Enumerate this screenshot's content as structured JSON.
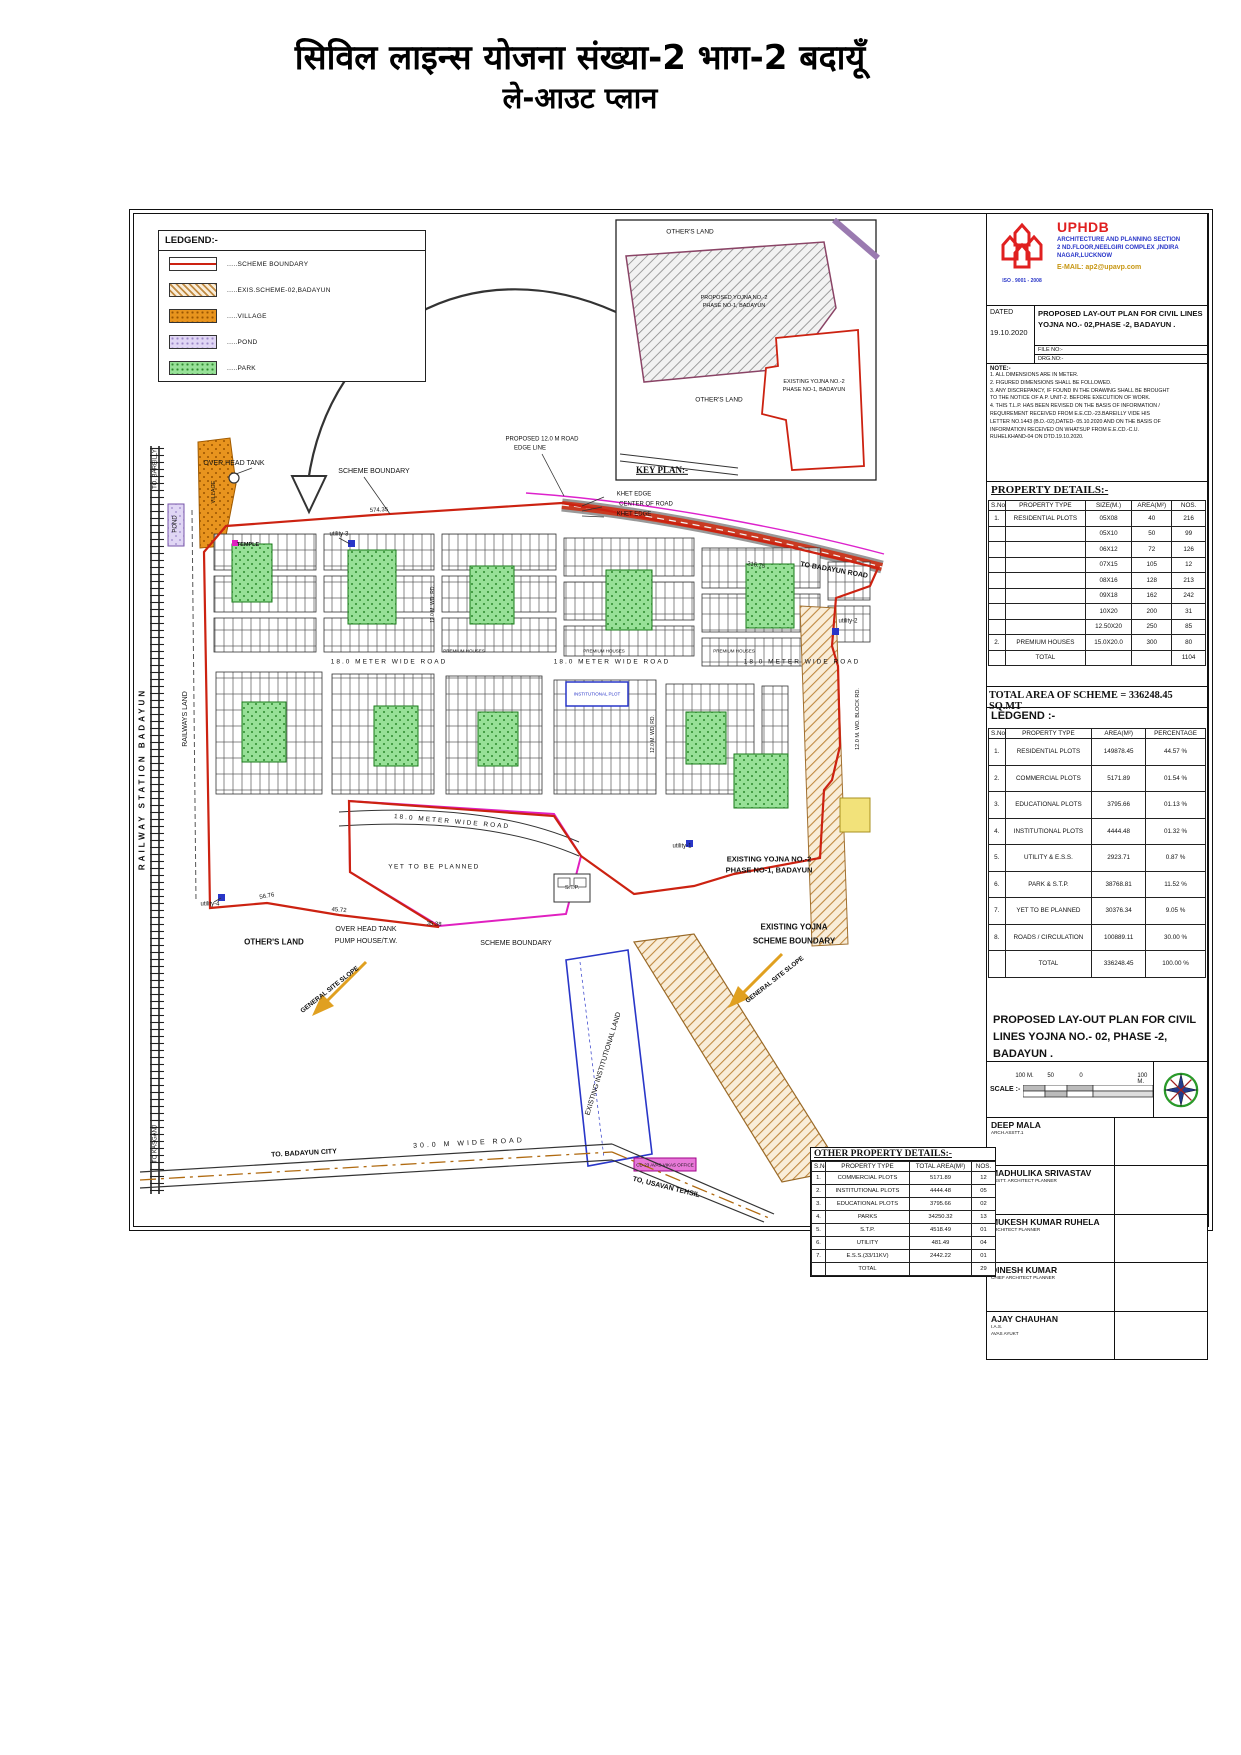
{
  "page_title": {
    "line1": "सिविल लाइन्स योजना संख्या-2 भाग-2 बदायूँ",
    "line2": "ले-आउट प्लान"
  },
  "legend_box": {
    "title": "LEDGEND:-",
    "items": [
      {
        "key": "scheme-boundary",
        "label": ".....SCHEME BOUNDARY"
      },
      {
        "key": "hatched",
        "label": ".....EXIS.SCHEME-02,BADAYUN"
      },
      {
        "key": "village",
        "label": ".....VILLAGE"
      },
      {
        "key": "pond",
        "label": ".....POND"
      },
      {
        "key": "park",
        "label": ".....PARK"
      }
    ]
  },
  "uphdb": {
    "org": "UPHDB",
    "iso": "ISO . 9001 - 2008",
    "dept": "ARCHITECTURE AND PLANNING SECTION",
    "address": "2 ND.FLOOR,NEELGIRI COMPLEX ,INDIRA NAGAR,LUCKNOW",
    "email_label": "E-MAIL:",
    "email": "ap2@upavp.com"
  },
  "title_block": {
    "dated_label": "DATED",
    "dated": "19.10.2020",
    "title": "PROPOSED LAY-OUT PLAN FOR CIVIL LINES YOJNA NO.- 02,PHASE -2, BADAYUN .",
    "file_no": "FILE NO:-",
    "drg_no": "DRG.NO:-"
  },
  "notes": {
    "heading": "NOTE:-",
    "lines": [
      "1. ALL DIMENSIONS ARE IN METER.",
      "2. FIGURED DIMENSIONS SHALL BE FOLLOWED.",
      "3. ANY DISCREPANCY, IF FOUND IN THE DRAWING SHALL BE BROUGHT",
      "    TO THE NOTICE OF A.P. UNIT-2. BEFORE EXECUTION OF WORK.",
      "4. THIS T.L.P. HAS BEEN REVISED ON THE BASIS OF INFORMATION /",
      "    REQUIREMENT RECEIVED FROM E.E.CD.-23.BAREILLY VIDE HIS",
      "    LETTER NO.1443 (B.D.-02),DATED- 05.10.2020 AND ON THE BASIS OF",
      "    INFORMATION RECEIVED ON WHATSUP FROM E.E.CD.-C.U.",
      "    RUHELKHAND-04 ON DTD.19.10.2020."
    ]
  },
  "property_details": {
    "title": "PROPERTY DETAILS:-",
    "columns": [
      "S.No.",
      "PROPERTY TYPE",
      "SIZE(M.)",
      "AREA(M²)",
      "NOS."
    ],
    "rows": [
      [
        "1.",
        "RESIDENTIAL PLOTS",
        "05X08",
        "40",
        "216"
      ],
      [
        "",
        "",
        "05X10",
        "50",
        "99"
      ],
      [
        "",
        "",
        "06X12",
        "72",
        "126"
      ],
      [
        "",
        "",
        "07X15",
        "105",
        "12"
      ],
      [
        "",
        "",
        "08X16",
        "128",
        "213"
      ],
      [
        "",
        "",
        "09X18",
        "162",
        "242"
      ],
      [
        "",
        "",
        "10X20",
        "200",
        "31"
      ],
      [
        "",
        "",
        "12.50X20",
        "250",
        "85"
      ],
      [
        "2.",
        "PREMIUM HOUSES",
        "15.0X20.0",
        "300",
        "80"
      ],
      [
        "",
        "TOTAL",
        "",
        "",
        "1104"
      ]
    ]
  },
  "total_area": "TOTAL AREA OF SCHEME = 336248.45 SQ.MT",
  "ledgend_table": {
    "title": "LEDGEND :-",
    "columns": [
      "S.No.",
      "PROPERTY TYPE",
      "AREA(M²)",
      "PERCENTAGE"
    ],
    "rows": [
      [
        "1.",
        "RESIDENTIAL PLOTS",
        "149878.45",
        "44.57 %"
      ],
      [
        "2.",
        "COMMERCIAL PLOTS",
        "5171.89",
        "01.54 %"
      ],
      [
        "3.",
        "EDUCATIONAL PLOTS",
        "3795.66",
        "01.13 %"
      ],
      [
        "4.",
        "INSTITUTIONAL PLOTS",
        "4444.48",
        "01.32 %"
      ],
      [
        "5.",
        "UTILITY & E.S.S.",
        "2923.71",
        "0.87 %"
      ],
      [
        "6.",
        "PARK & S.T.P.",
        "38768.81",
        "11.52 %"
      ],
      [
        "7.",
        "YET TO BE PLANNED",
        "30376.34",
        "9.05 %"
      ],
      [
        "8.",
        "ROADS / CIRCULATION",
        "100889.11",
        "30.00 %"
      ],
      [
        "",
        "TOTAL",
        "336248.45",
        "100.00 %"
      ]
    ]
  },
  "plan_title": "PROPOSED  LAY-OUT PLAN FOR CIVIL LINES YOJNA  NO.- 02, PHASE -2, BADAYUN .",
  "scale_bar": {
    "label": "SCALE :-",
    "ticks": [
      "100 M.",
      "50",
      "0",
      "100 M."
    ]
  },
  "signatures": [
    {
      "name": "DEEP MALA",
      "roles": [
        "ARCH.ASSTT.1"
      ]
    },
    {
      "name": "MADHULIKA SRIVASTAV",
      "roles": [
        "ASSTT. ARCHITECT PLANNER"
      ]
    },
    {
      "name": "MUKESH KUMAR RUHELA",
      "roles": [
        "ARCHITECT PLANNER"
      ]
    },
    {
      "name": "DINESH KUMAR",
      "roles": [
        "CHIEF ARCHITECT PLANNER"
      ]
    },
    {
      "name": "AJAY CHAUHAN",
      "roles": [
        "I.A.S.",
        "AVAS AYUKT"
      ]
    }
  ],
  "other_property": {
    "title": "OTHER PROPERTY DETAILS:-",
    "columns": [
      "S.No.",
      "PROPERTY TYPE",
      "TOTAL AREA(M²)",
      "NOS."
    ],
    "rows": [
      [
        "1.",
        "COMMERCIAL PLOTS",
        "5171.89",
        "12"
      ],
      [
        "2.",
        "INSTITUTIONAL PLOTS",
        "4444.48",
        "05"
      ],
      [
        "3.",
        "EDUCATIONAL PLOTS",
        "3795.66",
        "02"
      ],
      [
        "4.",
        "PARKS",
        "34250.32",
        "13"
      ],
      [
        "5.",
        "S.T.P.",
        "4518.49",
        "01"
      ],
      [
        "6.",
        "UTILITY",
        "481.49",
        "04"
      ],
      [
        "7.",
        "E.S.S.(33/11KV)",
        "2442.22",
        "01"
      ],
      [
        "",
        "TOTAL",
        "",
        "29"
      ]
    ]
  },
  "colors": {
    "scheme_boundary": "#cc2211",
    "exis_scheme_hatch": "#c08a42",
    "village": "#e8941e",
    "pond": "#e0d6f4",
    "park": "#97e097",
    "road_band": "#c93a22",
    "proposed_road_edge": "#dd22cc",
    "institutional": "#2936c8",
    "brand_red": "#e02020",
    "brand_blue": "#2936c8",
    "email_gold": "#c79612",
    "slope_arrow": "#e0a020"
  },
  "map_labels": [
    {
      "t": "OVER HEAD TANK",
      "x": 100,
      "y": 250,
      "s": 7
    },
    {
      "t": "SCHEME BOUNDARY",
      "x": 240,
      "y": 258,
      "s": 7
    },
    {
      "t": "PROPOSED 12.0 M ROAD",
      "x": 408,
      "y": 226,
      "s": 6
    },
    {
      "t": "EDGE LINE",
      "x": 396,
      "y": 235,
      "s": 6
    },
    {
      "t": "KHET EDGE",
      "x": 500,
      "y": 281,
      "s": 6
    },
    {
      "t": "CENTER OF ROAD",
      "x": 512,
      "y": 291,
      "s": 6
    },
    {
      "t": "KHET EDGE",
      "x": 500,
      "y": 301,
      "s": 6
    },
    {
      "t": "574.35",
      "x": 245,
      "y": 297,
      "s": 6,
      "r": -3
    },
    {
      "t": "216.75",
      "x": 622,
      "y": 352,
      "s": 6,
      "r": 9
    },
    {
      "t": "TO BADAYUN ROAD",
      "x": 700,
      "y": 357,
      "s": 7,
      "r": 10,
      "c": "b"
    },
    {
      "t": "utility-3",
      "x": 205,
      "y": 321,
      "s": 6
    },
    {
      "t": "TEMPLE",
      "x": 114,
      "y": 331,
      "s": 5.5,
      "c": "b"
    },
    {
      "t": "VILLAGE",
      "x": 80,
      "y": 278,
      "s": 5.5,
      "r": -90
    },
    {
      "t": "POND",
      "x": 42,
      "y": 310,
      "s": 6,
      "r": -90
    },
    {
      "t": "TO. BAREILLY",
      "x": 22,
      "y": 255,
      "s": 6,
      "r": -90
    },
    {
      "t": "TO KASGANJ",
      "x": 22,
      "y": 930,
      "s": 6,
      "r": -90
    },
    {
      "t": "RAILWAY STATION BADAYUN",
      "x": 8,
      "y": 565,
      "s": 8,
      "r": -90,
      "c": "b",
      "sp": 3
    },
    {
      "t": "RAILWAYS LAND",
      "x": 52,
      "y": 505,
      "s": 7,
      "r": -90
    },
    {
      "t": "18.0 METER WIDE ROAD",
      "x": 255,
      "y": 448,
      "s": 6.5,
      "sp": 2
    },
    {
      "t": "18.0 METER WIDE ROAD",
      "x": 478,
      "y": 448,
      "s": 6.5,
      "sp": 2
    },
    {
      "t": "18.0 METER WIDE ROAD",
      "x": 668,
      "y": 448,
      "s": 6.5,
      "sp": 2
    },
    {
      "t": "PREMIUM HOUSES",
      "x": 330,
      "y": 437,
      "s": 4.5
    },
    {
      "t": "PREMIUM HOUSES",
      "x": 470,
      "y": 437,
      "s": 4.5
    },
    {
      "t": "PREMIUM HOUSES",
      "x": 600,
      "y": 437,
      "s": 4.5
    },
    {
      "t": "utility-2",
      "x": 714,
      "y": 408,
      "s": 6
    },
    {
      "t": "12.0 M. WD. BLOCK RD.",
      "x": 724,
      "y": 505,
      "s": 5.5,
      "r": -90
    },
    {
      "t": "12.0 M. WD. RD.",
      "x": 300,
      "y": 390,
      "s": 5,
      "r": -90
    },
    {
      "t": "12.0 M. WD. RD.",
      "x": 520,
      "y": 520,
      "s": 5,
      "r": -90
    },
    {
      "t": "INSTITUTIONAL PLOT",
      "x": 463,
      "y": 480,
      "s": 4.5,
      "c": "blue"
    },
    {
      "t": "18.0 METER WIDE ROAD",
      "x": 318,
      "y": 608,
      "s": 6.5,
      "r": 5,
      "sp": 2
    },
    {
      "t": "YET TO BE PLANNED",
      "x": 300,
      "y": 653,
      "s": 6.5,
      "sp": 1.5
    },
    {
      "t": "EXISTING YOJNA NO.-2",
      "x": 635,
      "y": 646,
      "s": 7.5,
      "c": "b"
    },
    {
      "t": "PHASE NO-1, BADAYUN",
      "x": 635,
      "y": 657,
      "s": 7.5,
      "c": "b"
    },
    {
      "t": "utility-1",
      "x": 548,
      "y": 633,
      "s": 6
    },
    {
      "t": "S.T.P.",
      "x": 438,
      "y": 674,
      "s": 5.5
    },
    {
      "t": "utility-4",
      "x": 76,
      "y": 691,
      "s": 6
    },
    {
      "t": "56.76",
      "x": 133,
      "y": 683,
      "s": 6,
      "r": -10
    },
    {
      "t": "45.72",
      "x": 205,
      "y": 697,
      "s": 6,
      "r": 4
    },
    {
      "t": "35.38",
      "x": 300,
      "y": 711,
      "s": 6,
      "r": 4
    },
    {
      "t": "OTHER'S LAND",
      "x": 140,
      "y": 728,
      "s": 8,
      "c": "b"
    },
    {
      "t": "OVER HEAD TANK",
      "x": 232,
      "y": 716,
      "s": 7
    },
    {
      "t": "PUMP HOUSE/T.W.",
      "x": 232,
      "y": 728,
      "s": 7
    },
    {
      "t": "SCHEME BOUNDARY",
      "x": 382,
      "y": 730,
      "s": 7
    },
    {
      "t": "EXISTING YOJNA",
      "x": 660,
      "y": 713,
      "s": 8,
      "c": "b"
    },
    {
      "t": "SCHEME BOUNDARY",
      "x": 660,
      "y": 727,
      "s": 8,
      "c": "b"
    },
    {
      "t": "GENERAL SITE SLOPE",
      "x": 196,
      "y": 776,
      "s": 6.5,
      "r": -38,
      "c": "b"
    },
    {
      "t": "GENERAL SITE SLOPE",
      "x": 641,
      "y": 766,
      "s": 6.5,
      "r": -38,
      "c": "b"
    },
    {
      "t": "EXISTING INSTITUTIONAL LAND",
      "x": 470,
      "y": 850,
      "s": 7,
      "r": -73
    },
    {
      "t": "TO. BADAYUN CITY",
      "x": 170,
      "y": 940,
      "s": 7,
      "r": -3,
      "c": "b"
    },
    {
      "t": "30.0 M WIDE ROAD",
      "x": 335,
      "y": 930,
      "s": 7,
      "r": -3,
      "sp": 3
    },
    {
      "t": "TO, USAVAN TEHSIL",
      "x": 532,
      "y": 974,
      "s": 7,
      "r": 14,
      "c": "b"
    },
    {
      "t": "CD-23 AVAS VIKAS OFFICE",
      "x": 531,
      "y": 951,
      "s": 4.5
    },
    {
      "t": "OTHER'S LAND",
      "x": 556,
      "y": 18,
      "s": 6.5
    },
    {
      "t": "PROPOSED YOJNA NO.-2",
      "x": 600,
      "y": 84,
      "s": 5.5
    },
    {
      "t": "PHASE NO-1, BADAYUN",
      "x": 600,
      "y": 92,
      "s": 5.5
    },
    {
      "t": "EXISTING YOJNA NO.-2",
      "x": 680,
      "y": 168,
      "s": 5.5
    },
    {
      "t": "PHASE NO-1, BADAYUN",
      "x": 680,
      "y": 176,
      "s": 5.5
    },
    {
      "t": "OTHER'S LAND",
      "x": 585,
      "y": 186,
      "s": 6.5
    },
    {
      "t": "KEY PLAN:-",
      "x": 528,
      "y": 256,
      "s": 9,
      "c": "serifb"
    }
  ]
}
